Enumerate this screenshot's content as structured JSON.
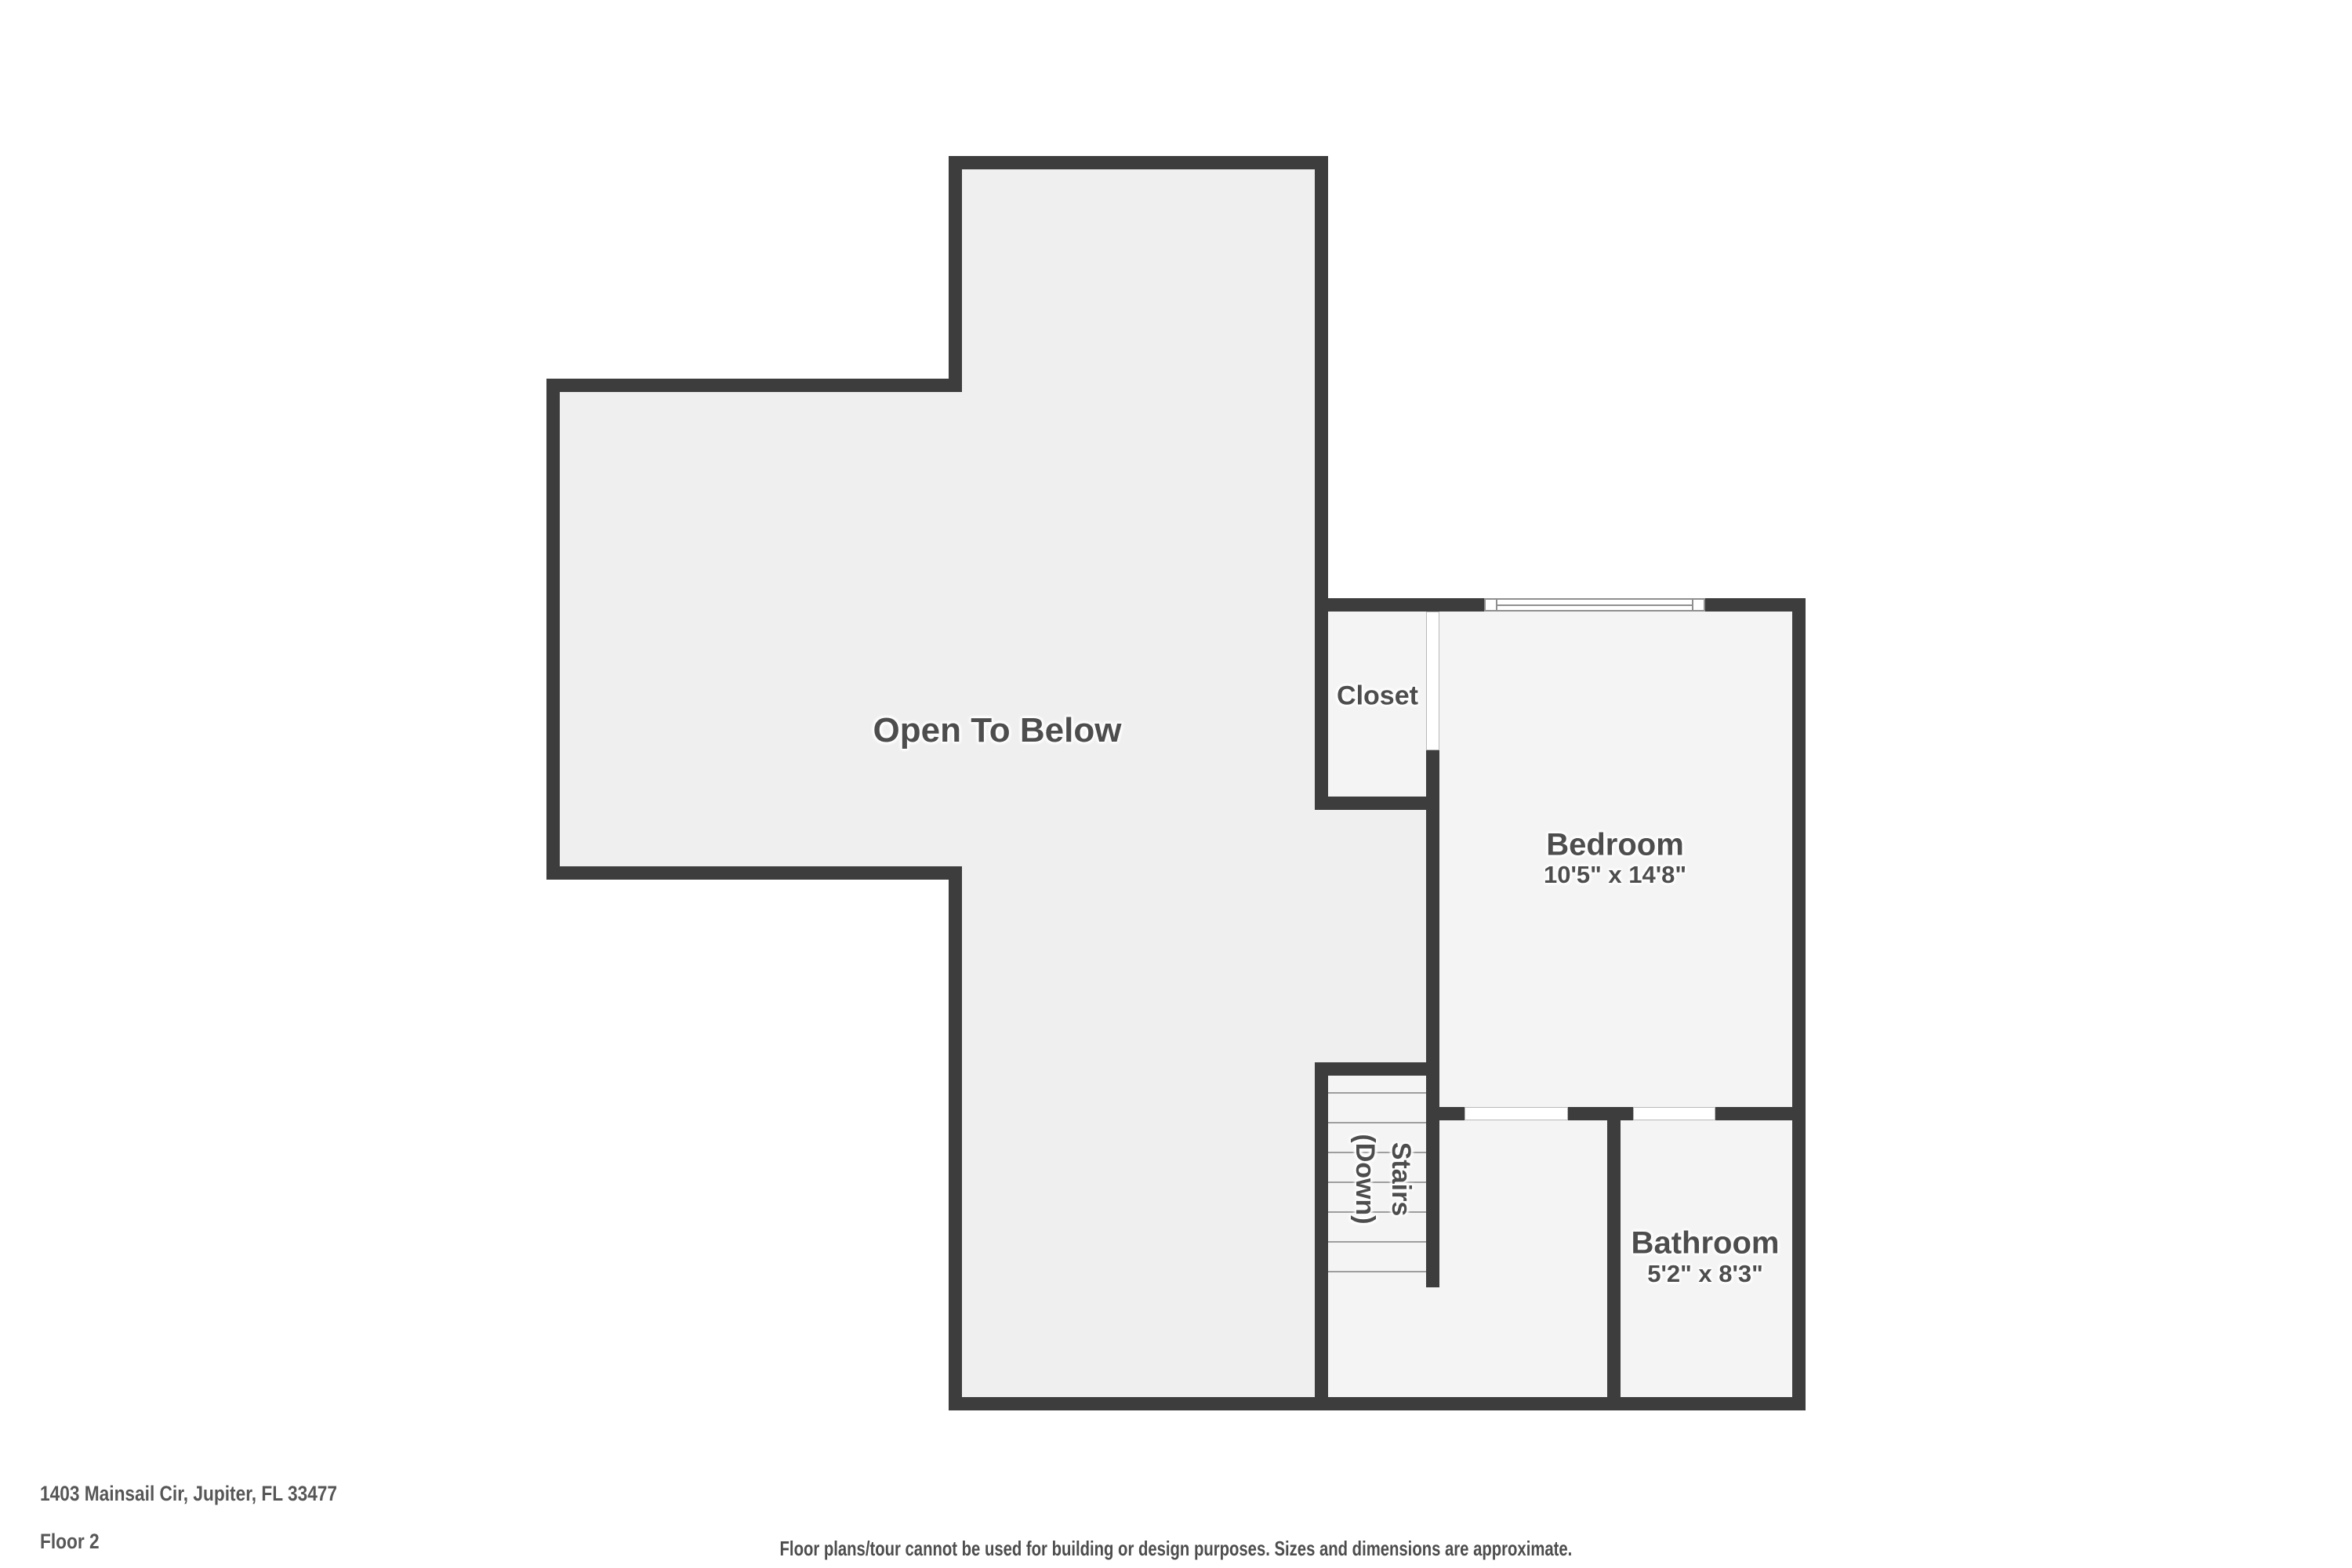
{
  "plan": {
    "rooms": {
      "open_to_below": {
        "label": "Open To Below"
      },
      "closet": {
        "label": "Closet"
      },
      "bedroom": {
        "label": "Bedroom",
        "dimensions": "10'5\" x 14'8\""
      },
      "stairs": {
        "label_line1": "Stairs",
        "label_line2": "(Down)"
      },
      "bathroom": {
        "label": "Bathroom",
        "dimensions": "5'2\" x 8'3\""
      }
    },
    "colors": {
      "wall": "#3d3d3d",
      "floor_open_area": "#efefef",
      "floor_rooms": "#f4f4f4",
      "label_text": "#4d4d4d",
      "background": "#ffffff"
    }
  },
  "footer": {
    "address": "1403 Mainsail Cir, Jupiter, FL 33477",
    "floor_label": "Floor 2",
    "disclaimer": "Floor plans/tour cannot be used for building or design purposes. Sizes and dimensions are approximate."
  }
}
